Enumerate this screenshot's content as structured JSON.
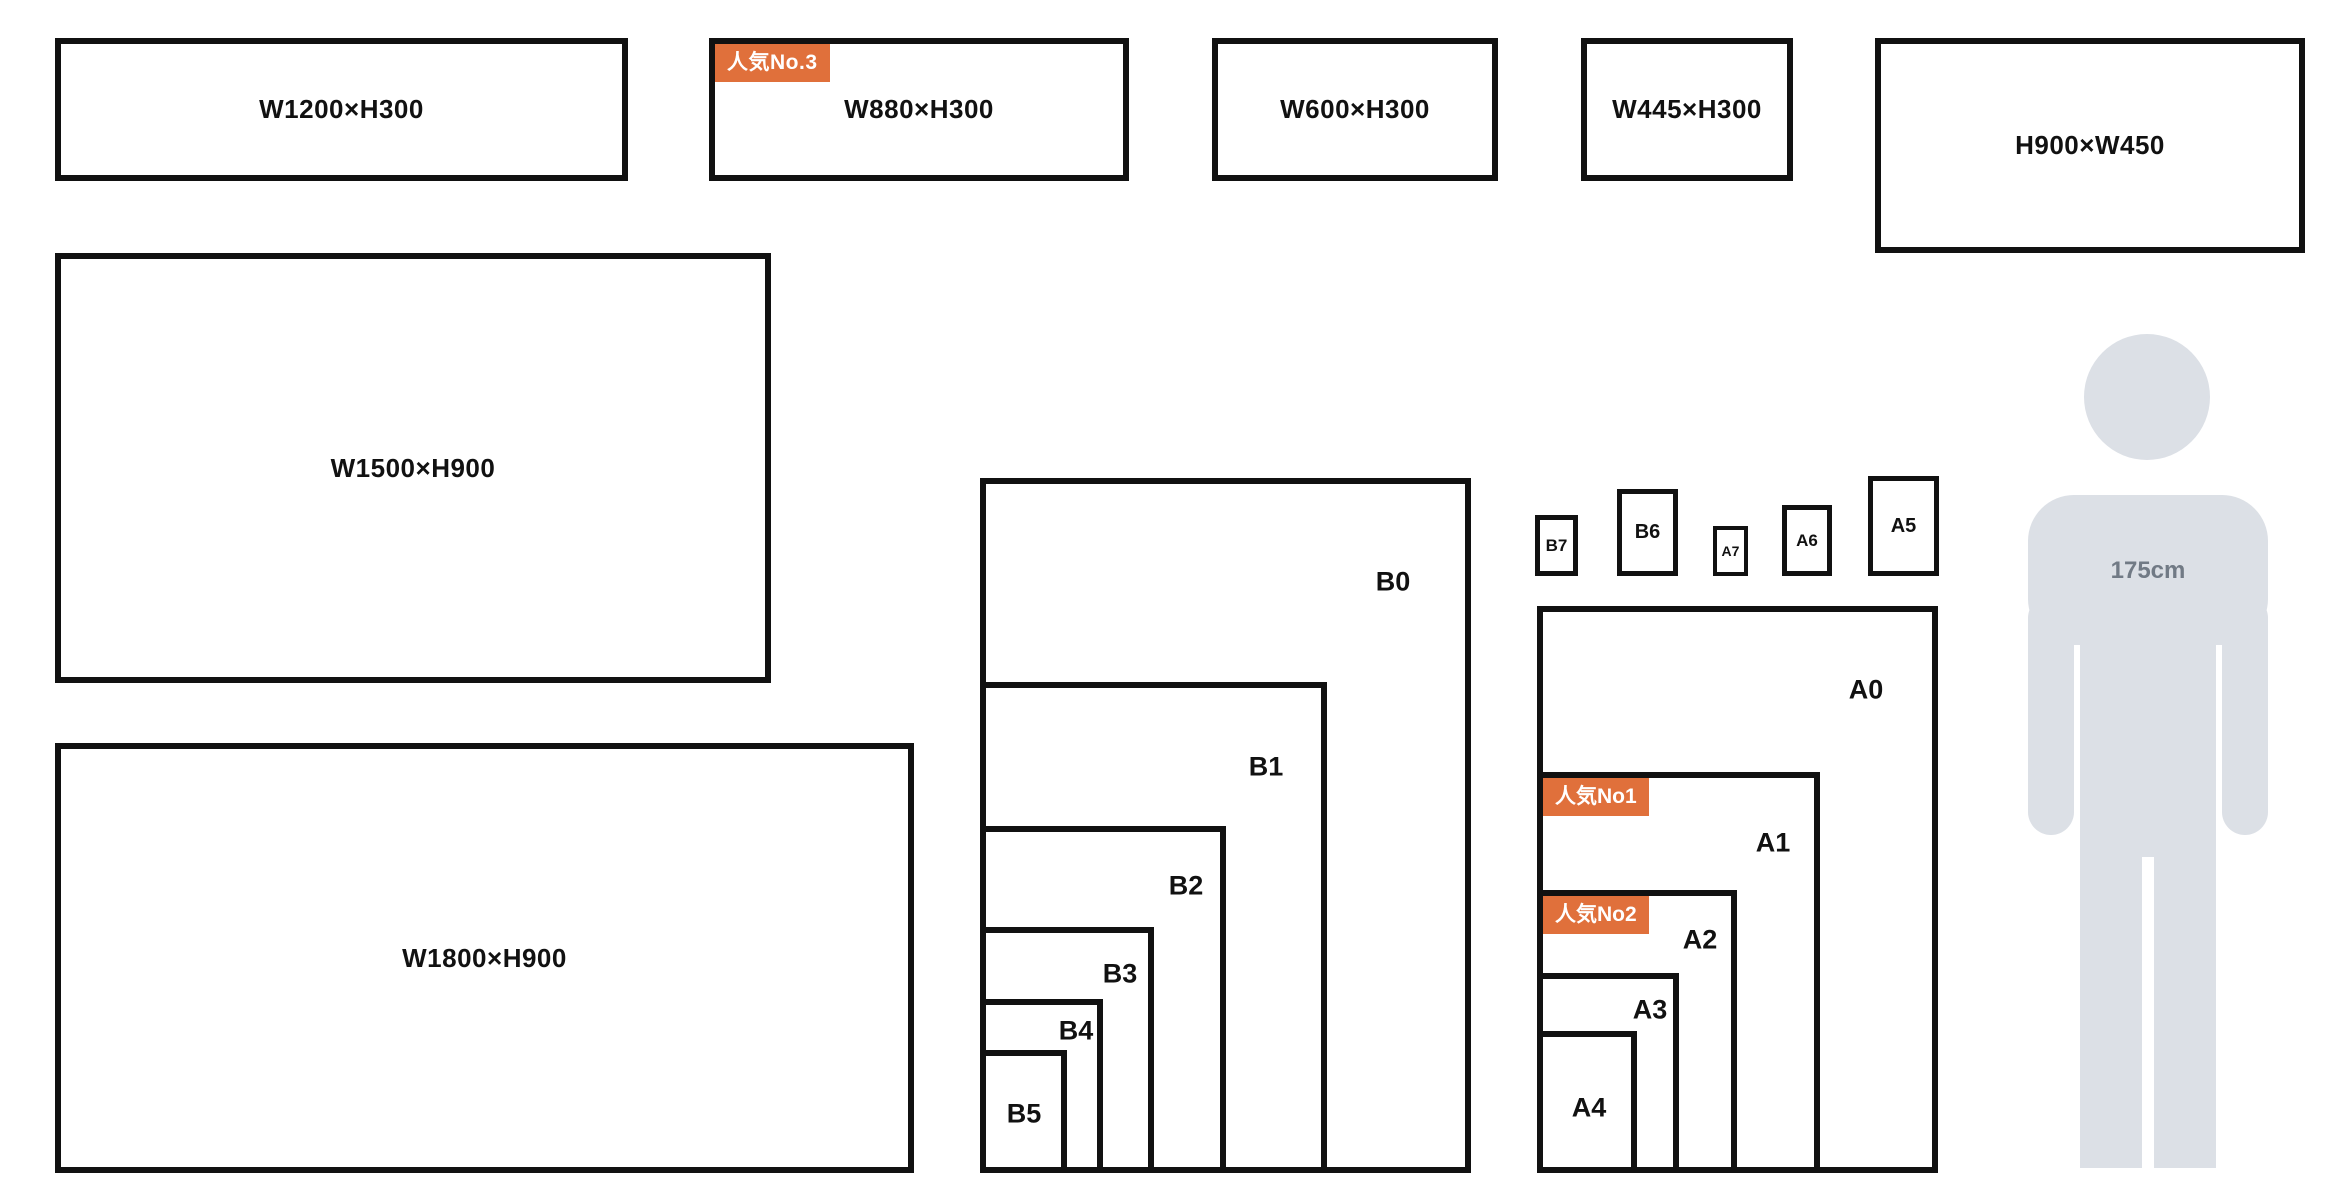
{
  "banners": [
    {
      "label": "W1200×H300"
    },
    {
      "label": "W880×H300"
    },
    {
      "label": "W600×H300"
    },
    {
      "label": "W445×H300"
    },
    {
      "label": "H900×W450"
    },
    {
      "label": "W1500×H900"
    },
    {
      "label": "W1800×H900"
    }
  ],
  "badges": {
    "no1": "人気No1",
    "no2": "人気No2",
    "no3": "人気No.3"
  },
  "b_series": [
    {
      "label": "B0"
    },
    {
      "label": "B1"
    },
    {
      "label": "B2"
    },
    {
      "label": "B3"
    },
    {
      "label": "B4"
    },
    {
      "label": "B5"
    }
  ],
  "a_series": [
    {
      "label": "A0"
    },
    {
      "label": "A1"
    },
    {
      "label": "A2"
    },
    {
      "label": "A3"
    },
    {
      "label": "A4"
    }
  ],
  "small_sizes": [
    {
      "label": "B7"
    },
    {
      "label": "B6"
    },
    {
      "label": "A7"
    },
    {
      "label": "A6"
    },
    {
      "label": "A5"
    }
  ],
  "figure": {
    "label": "175cm"
  },
  "colors": {
    "border": "#111111",
    "badge_bg": "#E0703B",
    "badge_text": "#ffffff",
    "figure_fill": "#DCE0E6",
    "figure_text": "#717A85"
  }
}
